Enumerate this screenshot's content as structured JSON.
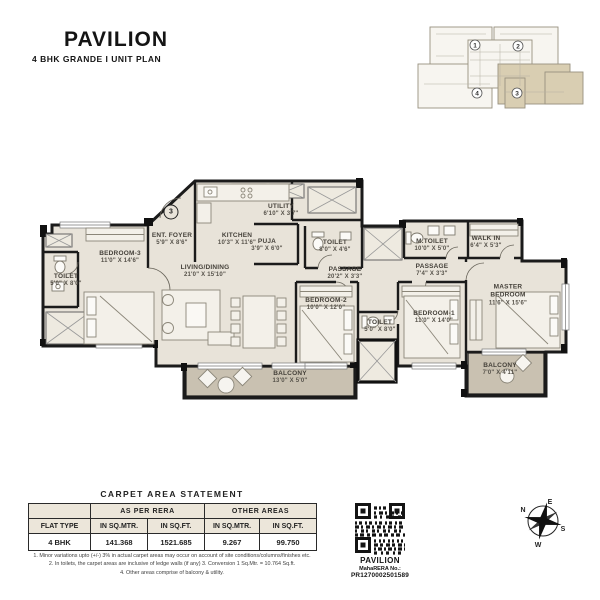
{
  "header": {
    "title": "PAVILION",
    "subtitle": "4 BHK GRANDE I UNIT PLAN"
  },
  "key_plan": {
    "units": [
      "1",
      "2",
      "3",
      "4"
    ],
    "highlighted_unit": "3"
  },
  "plan": {
    "entry_marker": "3",
    "rooms": [
      {
        "name": "TOILET",
        "dims": "5'0\" X 8'0\""
      },
      {
        "name": "BEDROOM-3",
        "dims": "11'0\" X 14'6\""
      },
      {
        "name": "ENT. FOYER",
        "dims": "5'9\" X 8'6\""
      },
      {
        "name": "KITCHEN",
        "dims": "10'3\" X 11'6\""
      },
      {
        "name": "UTILITY",
        "dims": "6'10\" X 3'7\""
      },
      {
        "name": "PUJA",
        "dims": "3'9\" X 6'0\""
      },
      {
        "name": "LIVING/DINING",
        "dims": "21'0\" X 15'10\""
      },
      {
        "name": "TOILET",
        "dims": "8'0\" X 4'6\""
      },
      {
        "name": "PASSAGE",
        "dims": "20'2\" X 3'3\""
      },
      {
        "name": "M.TOILET",
        "dims": "10'0\" X 5'0\""
      },
      {
        "name": "WALK IN",
        "dims": "6'4\" X 5'3\""
      },
      {
        "name": "PASSAGE",
        "dims": "7'4\" X 3'3\""
      },
      {
        "name": "BEDROOM-2",
        "dims": "10'0\" X 12'0\""
      },
      {
        "name": "TOILET",
        "dims": "5'0\" X 8'0\""
      },
      {
        "name": "BEDROOM-1",
        "dims": "11'0\" X 14'0\""
      },
      {
        "name": "MASTER BEDROOM",
        "dims": "11'6\" X 15'6\""
      },
      {
        "name": "BALCONY",
        "dims": "13'0\" X 5'0\""
      },
      {
        "name": "BALCONY",
        "dims": "7'0\" X 4'11\""
      }
    ]
  },
  "table": {
    "title": "CARPET AREA STATEMENT",
    "col_groups": [
      "AS PER RERA",
      "OTHER AREAS"
    ],
    "headers": [
      "FLAT TYPE",
      "IN SQ.MTR.",
      "IN SQ.FT.",
      "IN SQ.MTR.",
      "IN SQ.FT."
    ],
    "rows": [
      [
        "4 BHK",
        "141.368",
        "1521.685",
        "9.267",
        "99.750"
      ]
    ]
  },
  "footnotes": [
    "1. Minor variations upto (+/-) 3% in actual carpet areas may occur on account of site conditions/columns/finishes etc.",
    "2. In toilets, the carpet areas are inclusive of ledge walls (if any) 3. Conversion 1 Sq.Mtr. = 10.764 Sq.ft.",
    "4. Other areas comprise of balcony & utility."
  ],
  "rera": {
    "project": "PAVILION",
    "label": "MahaRERA No.:",
    "number": "PR1270002501589"
  },
  "compass": {
    "n": "N",
    "e": "E",
    "s": "S",
    "w": "W"
  },
  "colors": {
    "room_fill": "#e8e3d9",
    "balcony_fill": "#c9c1b1",
    "wall": "#1b1b1b",
    "highlight_unit": "#d9ceb2"
  }
}
